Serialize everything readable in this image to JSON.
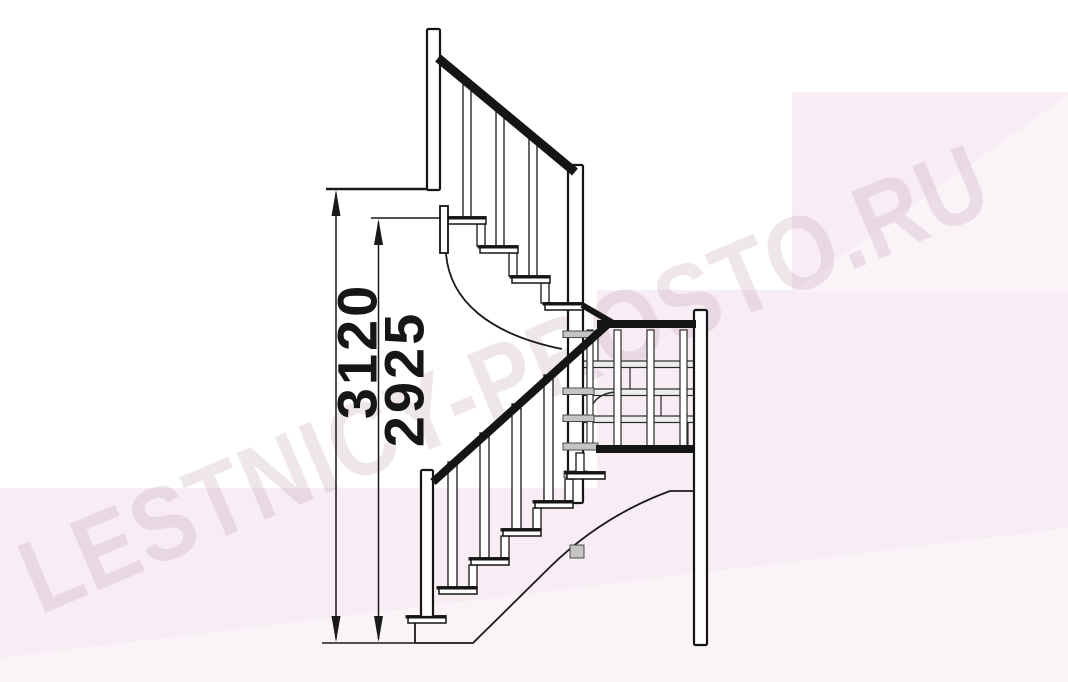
{
  "page": {
    "title": "Staircase side elevation drawing"
  },
  "watermark": {
    "text": "LESTNICY-PROSTO.RU"
  },
  "dimensions": {
    "total_height": "3120",
    "upper_reference_height": "2925"
  },
  "colors": {
    "line": "#151515",
    "pink_wash": "#f8edf4",
    "gray_part": "#c4c4c4"
  }
}
